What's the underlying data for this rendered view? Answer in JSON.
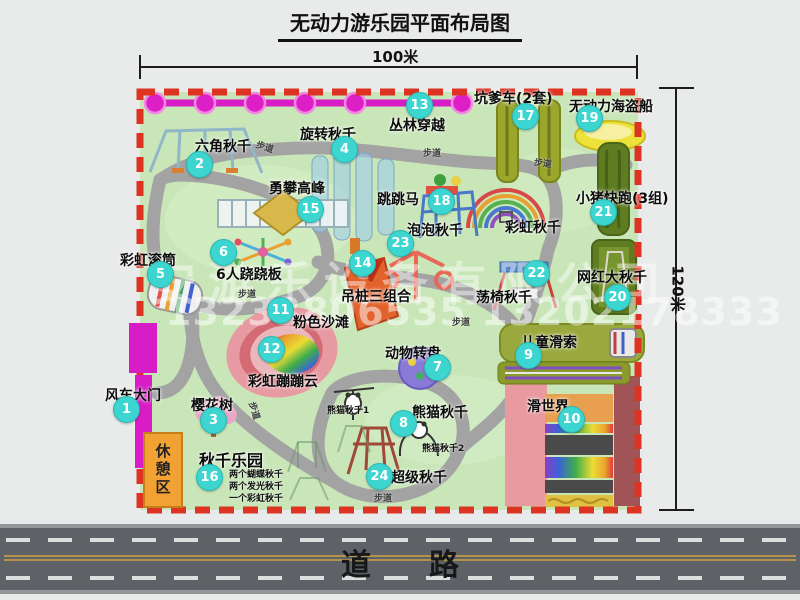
{
  "title": "无动力游乐园平面布局图",
  "scale": {
    "width_label": "100米",
    "height_label": "120米"
  },
  "road": {
    "label": "道路"
  },
  "path_label": "步道",
  "rest_area_label": "休憩区",
  "watermark": {
    "company": "安游乐设备有限公司",
    "phone": "13233806535 13202178333"
  },
  "unnumbered": {
    "rainbow_swing": "彩虹秋千"
  },
  "notes": {
    "swing_park": [
      "两个蝴蝶秋千",
      "两个发光秋千",
      "一个彩虹秋千"
    ],
    "panda_sub1": "熊猫秋千1",
    "panda_sub2": "熊猫秋千2"
  },
  "attractions": [
    {
      "num": "1",
      "name": "风车大门"
    },
    {
      "num": "2",
      "name": "六角秋千"
    },
    {
      "num": "3",
      "name": "樱花树"
    },
    {
      "num": "4",
      "name": "旋转秋千"
    },
    {
      "num": "5",
      "name": "彩虹滚筒"
    },
    {
      "num": "6",
      "name": "6人跷跷板"
    },
    {
      "num": "7",
      "name": "动物转盘"
    },
    {
      "num": "8",
      "name": "熊猫秋千"
    },
    {
      "num": "9",
      "name": "儿童滑索"
    },
    {
      "num": "10",
      "name": "滑世界"
    },
    {
      "num": "11",
      "name": "粉色沙滩"
    },
    {
      "num": "12",
      "name": "彩虹蹦蹦云"
    },
    {
      "num": "13",
      "name": "丛林穿越"
    },
    {
      "num": "14",
      "name": "吊桩三组合"
    },
    {
      "num": "15",
      "name": "勇攀高峰"
    },
    {
      "num": "16",
      "name": "秋千乐园"
    },
    {
      "num": "17",
      "name": "坑爹车(2套)"
    },
    {
      "num": "18",
      "name": "跳跳马"
    },
    {
      "num": "19",
      "name": "无动力海盗船"
    },
    {
      "num": "20",
      "name": "网红大秋千"
    },
    {
      "num": "21",
      "name": "小猪快跑(3组)"
    },
    {
      "num": "22",
      "name": "荡椅秋千"
    },
    {
      "num": "23",
      "name": "泡泡秋千"
    },
    {
      "num": "24",
      "name": "超级秋千"
    }
  ],
  "colors": {
    "badge": "#3cd5d0",
    "border_dash": "#dd3322",
    "park_green": "#c9e6b8",
    "gate_magenta": "#d81cc6",
    "road_gray": "#5e6165",
    "rest_orange": "#f2a233"
  }
}
